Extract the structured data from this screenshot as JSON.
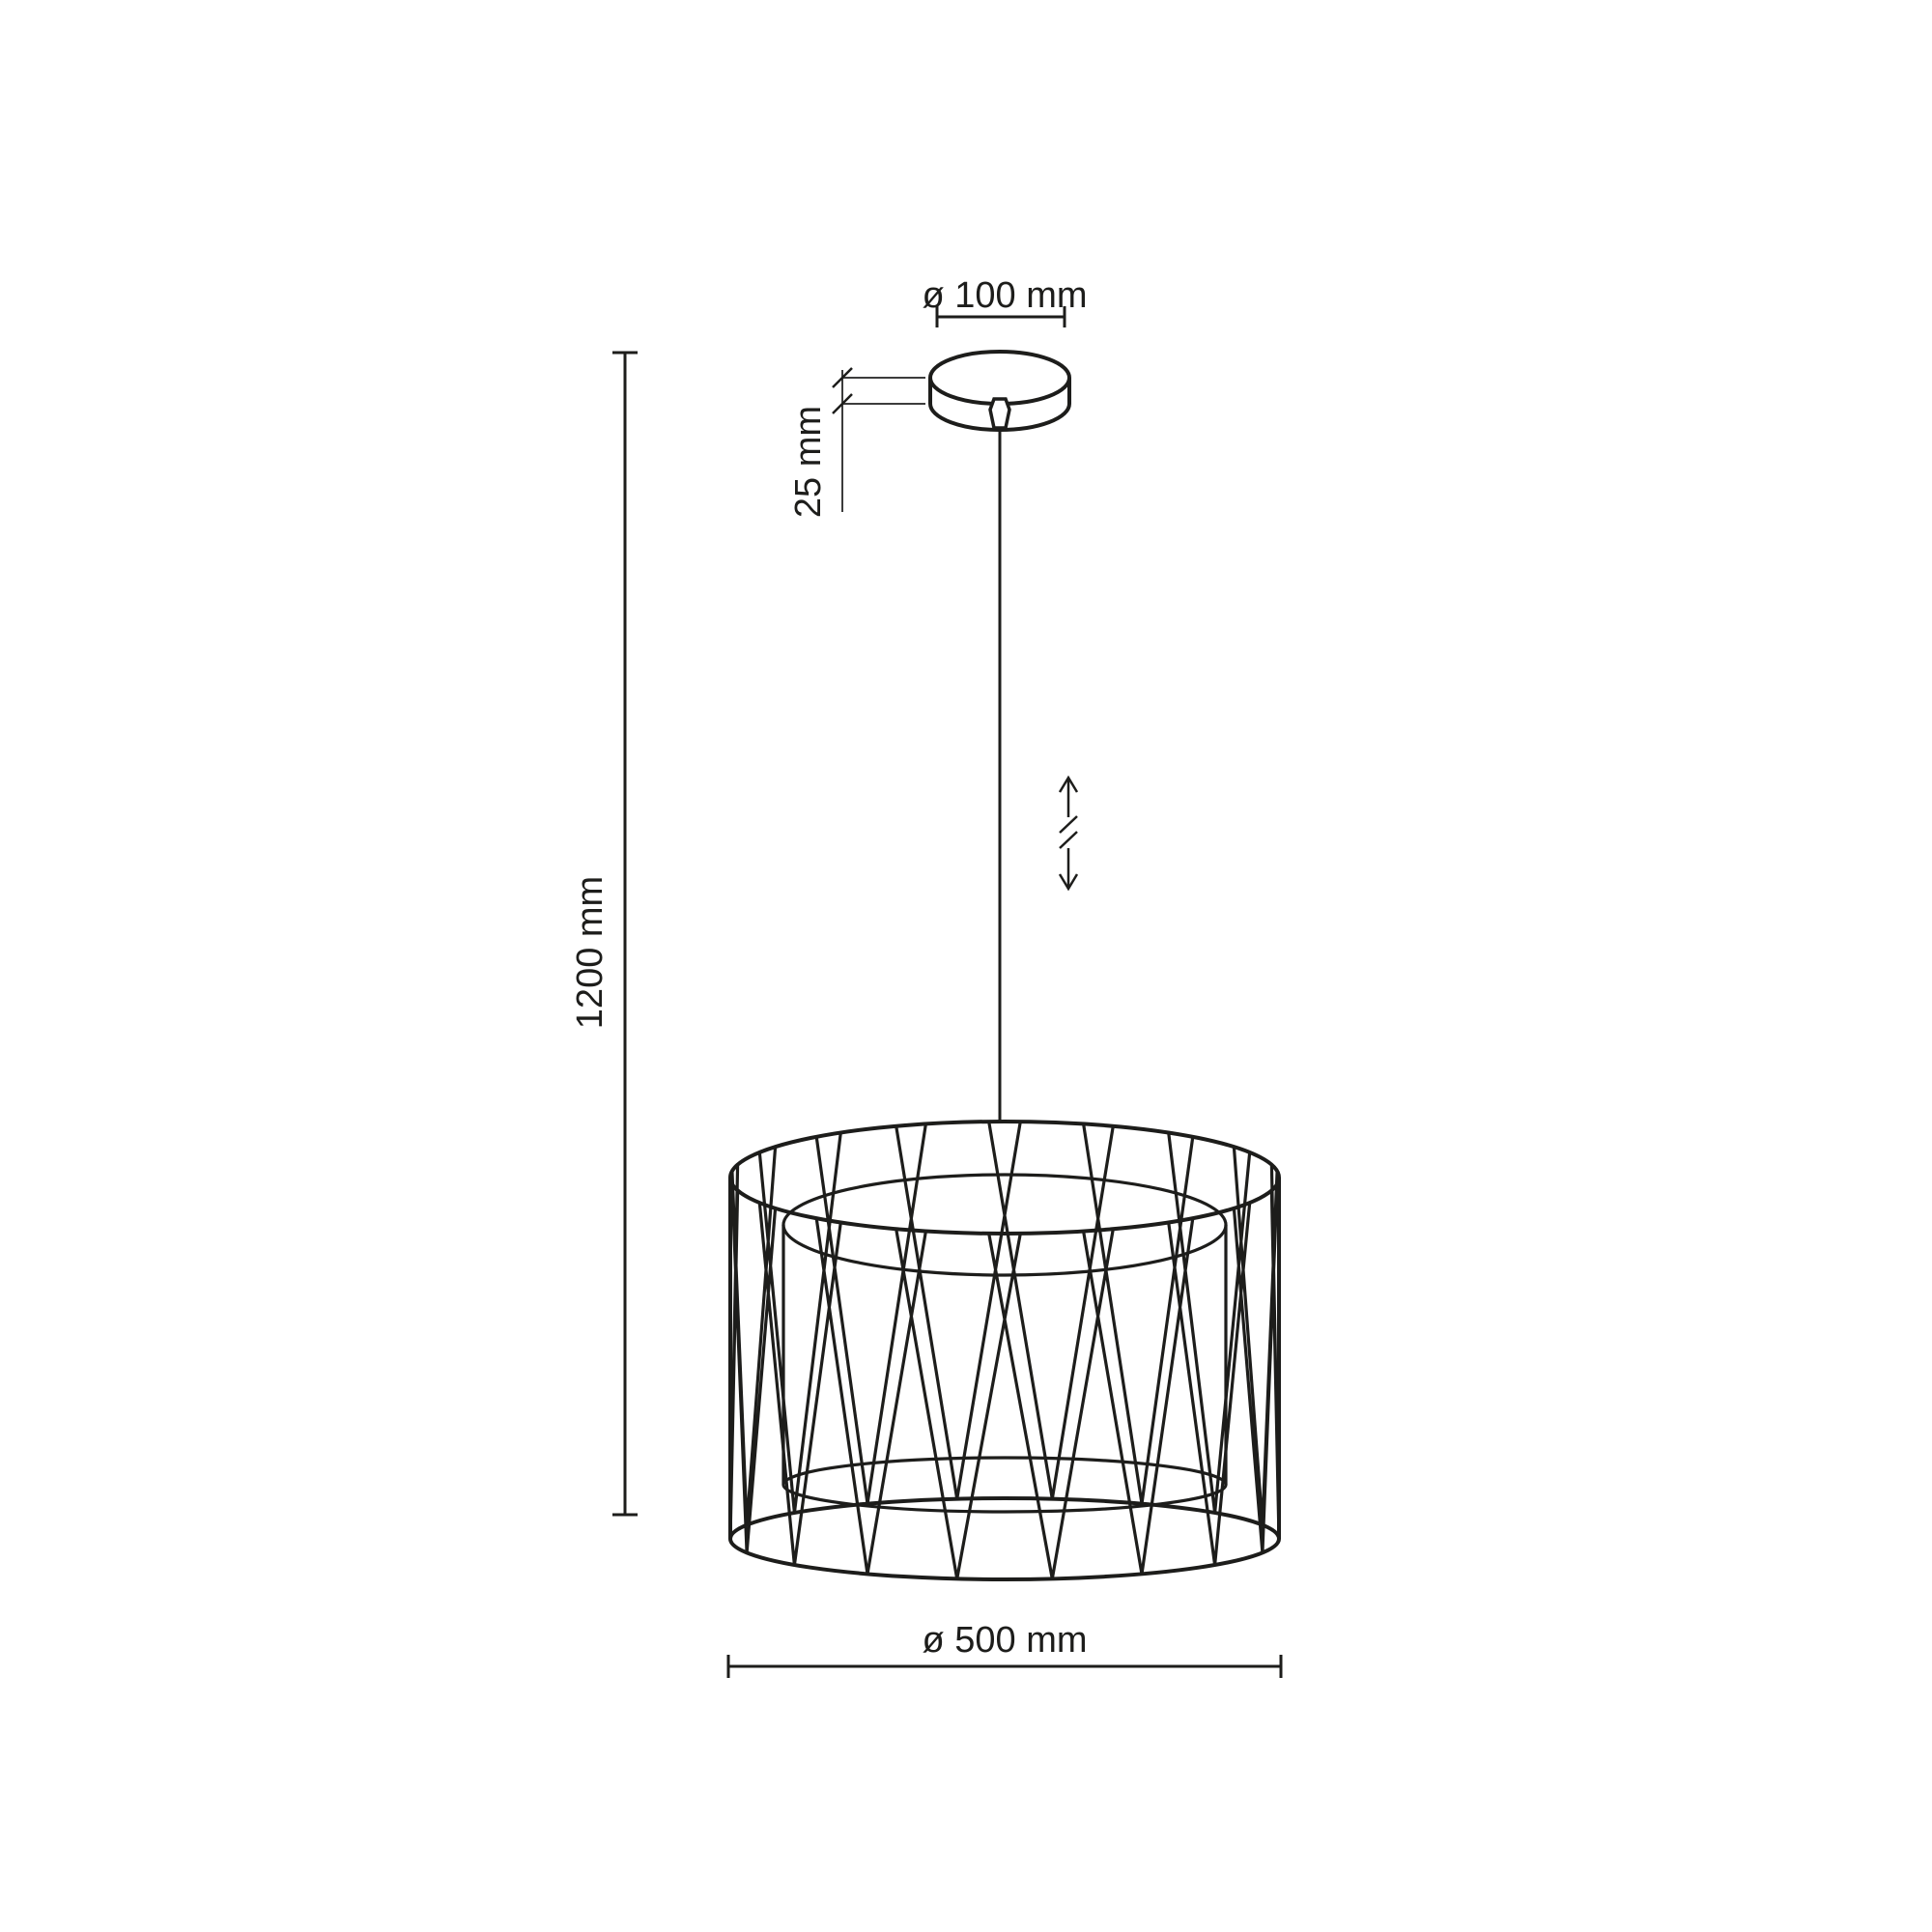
{
  "diagram": {
    "type": "pendant-lamp-dimension-drawing",
    "line_color": "#1d1d1b",
    "background_color": "#ffffff",
    "labels": {
      "canopy_diameter": "ø 100 mm",
      "canopy_height": "25 mm",
      "overall_height": "1200 mm",
      "shade_diameter": "ø 500 mm"
    }
  }
}
